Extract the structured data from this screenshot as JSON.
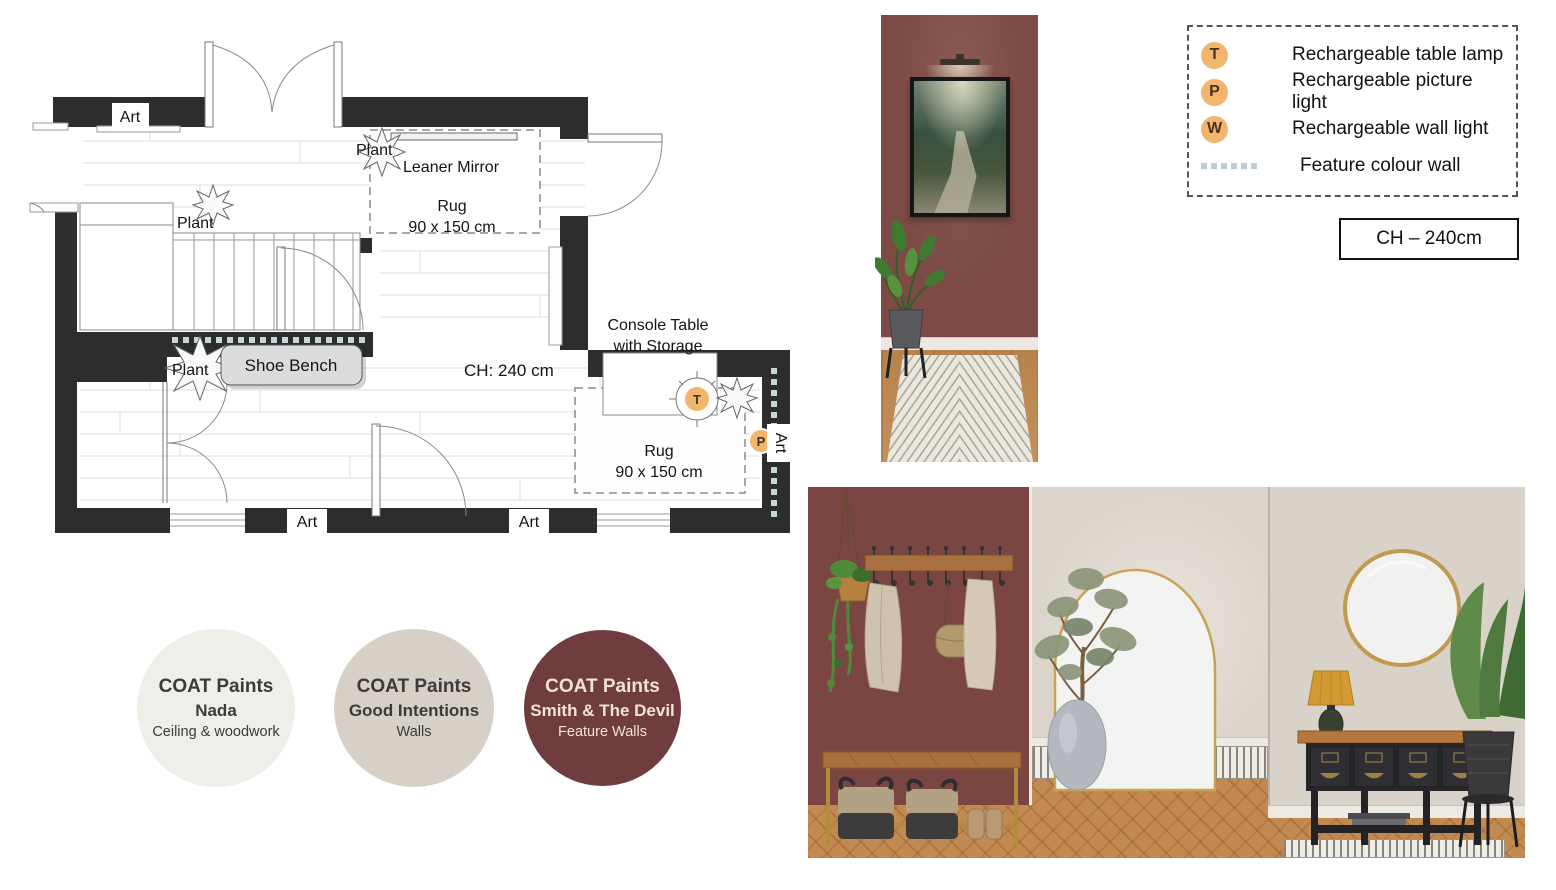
{
  "floorplan": {
    "labels": {
      "art_top": "Art",
      "art_bottom_left": "Art",
      "art_bottom_right": "Art",
      "art_right": "Art",
      "plant_stairs": "Plant",
      "plant_mirror": "Plant",
      "plant_bench": "Plant",
      "leaner_mirror": "Leaner Mirror",
      "rug_top_1": "Rug",
      "rug_top_2": "90 x 150 cm",
      "rug_bottom_1": "Rug",
      "rug_bottom_2": "90 x 150 cm",
      "shoe_bench": "Shoe Bench",
      "ch_room": "CH: 240 cm",
      "console_1": "Console Table",
      "console_2": "with Storage",
      "marker_t": "T",
      "marker_p": "P"
    }
  },
  "legend": {
    "items": [
      {
        "symbol": "T",
        "label": "Rechargeable table lamp"
      },
      {
        "symbol": "P",
        "label": "Rechargeable picture light"
      },
      {
        "symbol": "W",
        "label": "Rechargeable wall light"
      },
      {
        "symbol": "dots",
        "label": "Feature colour wall"
      }
    ],
    "ch_box": "CH – 240cm"
  },
  "paints": [
    {
      "brand": "COAT Paints",
      "name": "Nada",
      "use": "Ceiling & woodwork",
      "color": "#f0eee9"
    },
    {
      "brand": "COAT Paints",
      "name": "Good Intentions",
      "use": "Walls",
      "color": "#d7d0c6"
    },
    {
      "brand": "COAT Paints",
      "name": "Smith & The Devil",
      "use": "Feature Walls",
      "color": "#6f3d3d"
    }
  ],
  "colors": {
    "plan_wall": "#2d2d2d",
    "marker_orange": "#f2b56d",
    "feature_dot": "#c7d6d9",
    "maroon_wall": "#7b4642",
    "beige_wall": "#d9d2c8",
    "wood_floor": "#c28a50"
  }
}
